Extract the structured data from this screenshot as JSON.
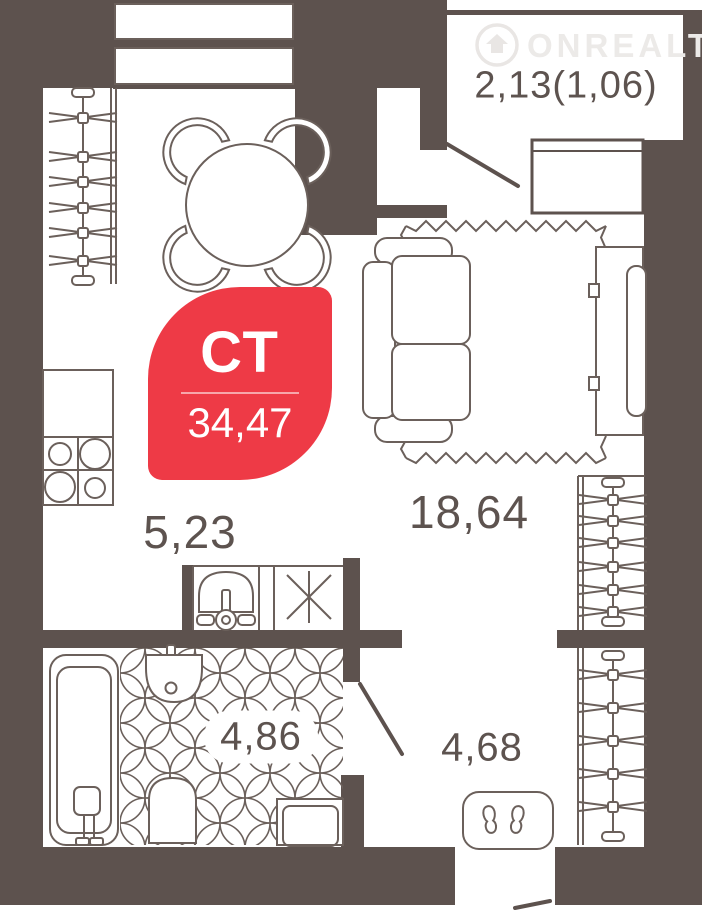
{
  "plan": {
    "title": "studio apartment floor plan",
    "watermark": {
      "text": "ONREALT",
      "icon": "house-circle-icon"
    },
    "badge": {
      "apartment_type": "СТ",
      "total_area": "34,47",
      "color": "#ee3a46"
    },
    "rooms": [
      {
        "id": "balcony",
        "area_label": "2,13(1,06)"
      },
      {
        "id": "living-room",
        "area_label": "18,64"
      },
      {
        "id": "kitchen",
        "area_label": "5,23"
      },
      {
        "id": "bathroom",
        "area_label": "4,86"
      },
      {
        "id": "hallway",
        "area_label": "4,68"
      }
    ],
    "colors": {
      "wall": "#5d524e",
      "furniture_line": "#6b605b",
      "label_text": "#5d534f",
      "accent_red": "#ee3a46",
      "watermark": "#eceae8",
      "background": "#ffffff"
    },
    "icons": [
      "wardrobe-icon",
      "hanger-rail-icon",
      "dining-table-icon",
      "chair-icon",
      "sofa-icon",
      "rug-icon",
      "tv-unit-icon",
      "stove-icon",
      "kitchen-cabinet-icon",
      "sink-vanity-icon",
      "asterisk-symbol",
      "bathtub-icon",
      "wash-basin-icon",
      "toilet-icon",
      "washing-machine-icon",
      "doormat-icon",
      "window-icon",
      "door-leaf-icon"
    ]
  }
}
